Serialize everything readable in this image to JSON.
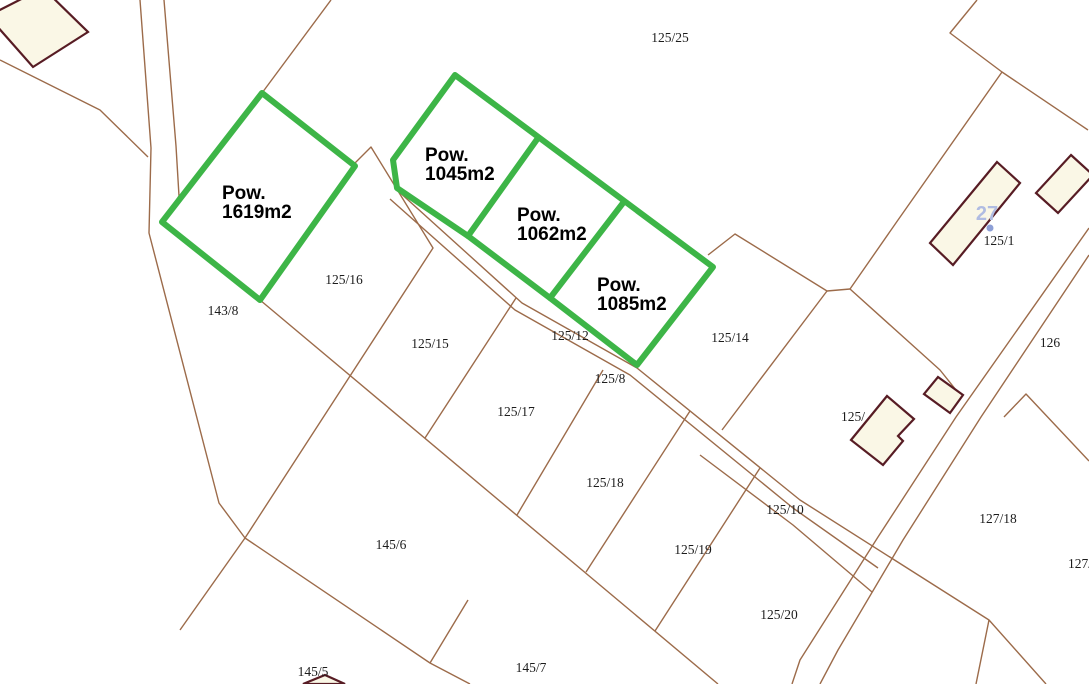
{
  "map": {
    "title": "Cadastral parcel map",
    "canvas": {
      "width": 1089,
      "height": 684,
      "background": "#ffffff"
    },
    "colors": {
      "parcel_line": "#9c6b4a",
      "building_stroke": "#571c24",
      "building_fill": "#faf7e6",
      "highlight_green": "#3db547",
      "label_text": "#1c1c1c",
      "area_label_text": "#000000",
      "address_blue": "#b0bce2",
      "address_dot": "#8d9fd6"
    },
    "parcel_lines": {
      "width": 1.4,
      "paths": [
        [
          [
            140,
            0
          ],
          [
            151,
            148
          ],
          [
            149,
            233
          ],
          [
            219,
            503
          ],
          [
            245,
            538
          ]
        ],
        [
          [
            245,
            538
          ],
          [
            180,
            630
          ]
        ],
        [
          [
            245,
            538
          ],
          [
            430,
            663
          ],
          [
            470,
            684
          ]
        ],
        [
          [
            468,
            600
          ],
          [
            430,
            663
          ]
        ],
        [
          [
            164,
            0
          ],
          [
            176,
            146
          ],
          [
            179,
            196
          ],
          [
            163,
            221
          ]
        ],
        [
          [
            0,
            60
          ],
          [
            100,
            110
          ],
          [
            148,
            157
          ]
        ],
        [
          [
            331,
            0
          ],
          [
            262,
            93
          ]
        ],
        [
          [
            353,
            165
          ],
          [
            371,
            147
          ],
          [
            433,
            248
          ],
          [
            245,
            538
          ]
        ],
        [
          [
            516,
            298
          ],
          [
            425,
            438
          ]
        ],
        [
          [
            603,
            370
          ],
          [
            517,
            515
          ]
        ],
        [
          [
            690,
            411
          ],
          [
            586,
            572
          ]
        ],
        [
          [
            760,
            468
          ],
          [
            655,
            631
          ]
        ],
        [
          [
            260,
            300
          ],
          [
            718,
            684
          ]
        ],
        [
          [
            397,
            190
          ],
          [
            522,
            303
          ],
          [
            637,
            368
          ],
          [
            800,
            500
          ],
          [
            989,
            620
          ],
          [
            1046,
            684
          ]
        ],
        [
          [
            390,
            199
          ],
          [
            515,
            310
          ],
          [
            630,
            375
          ],
          [
            793,
            508
          ],
          [
            878,
            568
          ]
        ],
        [
          [
            700,
            455
          ],
          [
            793,
            525
          ],
          [
            872,
            592
          ]
        ],
        [
          [
            1089,
            255
          ],
          [
            981,
            417
          ],
          [
            903,
            540
          ],
          [
            838,
            650
          ],
          [
            820,
            684
          ]
        ],
        [
          [
            1089,
            228
          ],
          [
            956,
            417
          ],
          [
            878,
            537
          ],
          [
            800,
            660
          ],
          [
            792,
            684
          ]
        ],
        [
          [
            977,
            0
          ],
          [
            950,
            33
          ],
          [
            1002,
            72
          ],
          [
            898,
            220
          ],
          [
            850,
            289
          ]
        ],
        [
          [
            1002,
            72
          ],
          [
            1088,
            130
          ]
        ],
        [
          [
            850,
            289
          ],
          [
            940,
            370
          ],
          [
            960,
            395
          ]
        ],
        [
          [
            708,
            255
          ],
          [
            735,
            234
          ],
          [
            827,
            291
          ],
          [
            850,
            289
          ]
        ],
        [
          [
            827,
            291
          ],
          [
            722,
            430
          ]
        ],
        [
          [
            1004,
            417
          ],
          [
            1026,
            394
          ],
          [
            1089,
            461
          ]
        ],
        [
          [
            989,
            620
          ],
          [
            976,
            684
          ]
        ]
      ]
    },
    "buildings": {
      "stroke_width": 2.2,
      "items": [
        {
          "name": "building-top-left",
          "points": [
            [
              -12,
              16
            ],
            [
              43,
              -12
            ],
            [
              88,
              32
            ],
            [
              33,
              67
            ]
          ]
        },
        {
          "name": "building-125-1",
          "points": [
            [
              997,
              162
            ],
            [
              1020,
              183
            ],
            [
              953,
              265
            ],
            [
              930,
              243
            ]
          ]
        },
        {
          "name": "building-top-right",
          "points": [
            [
              1071,
              155
            ],
            [
              1093,
              175
            ],
            [
              1058,
              213
            ],
            [
              1036,
              193
            ]
          ]
        },
        {
          "name": "building-l-shaped",
          "points": [
            [
              887,
              396
            ],
            [
              914,
              419
            ],
            [
              898,
              436
            ],
            [
              903,
              441
            ],
            [
              883,
              465
            ],
            [
              851,
              440
            ]
          ]
        },
        {
          "name": "building-small-square",
          "points": [
            [
              938,
              377
            ],
            [
              963,
              395
            ],
            [
              950,
              413
            ],
            [
              924,
              394
            ]
          ]
        },
        {
          "name": "building-bottom-edge",
          "points": [
            [
              325,
              675
            ],
            [
              345,
              684
            ],
            [
              303,
              684
            ]
          ]
        }
      ]
    },
    "parcel_labels": {
      "font_size": 13.5,
      "items": [
        {
          "text": "125/25",
          "x": 670,
          "y": 42
        },
        {
          "text": "143/8",
          "x": 223,
          "y": 315
        },
        {
          "text": "125/16",
          "x": 344,
          "y": 284
        },
        {
          "text": "125/15",
          "x": 430,
          "y": 348
        },
        {
          "text": "125/12",
          "x": 570,
          "y": 340
        },
        {
          "text": "125/8",
          "x": 610,
          "y": 383
        },
        {
          "text": "125/14",
          "x": 730,
          "y": 342
        },
        {
          "text": "125/17",
          "x": 516,
          "y": 416
        },
        {
          "text": "125/18",
          "x": 605,
          "y": 487
        },
        {
          "text": "125/19",
          "x": 693,
          "y": 554
        },
        {
          "text": "125/10",
          "x": 785,
          "y": 514
        },
        {
          "text": "125/20",
          "x": 779,
          "y": 619
        },
        {
          "text": "145/6",
          "x": 391,
          "y": 549
        },
        {
          "text": "145/5",
          "x": 313,
          "y": 676
        },
        {
          "text": "145/7",
          "x": 531,
          "y": 672
        },
        {
          "text": "125/1",
          "x": 999,
          "y": 245
        },
        {
          "text": "126",
          "x": 1050,
          "y": 347
        },
        {
          "text": "127/18",
          "x": 998,
          "y": 523
        },
        {
          "text": "127/",
          "x": 1080,
          "y": 568
        },
        {
          "text": "125/",
          "x": 853,
          "y": 421,
          "behind_buildings": true
        }
      ]
    },
    "highlight": {
      "stroke_width": 6,
      "shapes": [
        {
          "name": "highlight-parcel-1619",
          "closed": true,
          "points": [
            [
              262,
              93
            ],
            [
              355,
              166
            ],
            [
              260,
              300
            ],
            [
              162,
              222
            ]
          ]
        },
        {
          "name": "highlight-parcel-band",
          "closed": true,
          "points": [
            [
              455,
              75
            ],
            [
              713,
              267
            ],
            [
              637,
              365
            ],
            [
              550,
              298
            ],
            [
              468,
              236
            ],
            [
              397,
              188
            ],
            [
              393,
              160
            ]
          ]
        },
        {
          "name": "highlight-divider-1",
          "closed": false,
          "points": [
            [
              538,
              138
            ],
            [
              468,
              236
            ]
          ]
        },
        {
          "name": "highlight-divider-2",
          "closed": false,
          "points": [
            [
              623,
              203
            ],
            [
              550,
              298
            ]
          ]
        }
      ],
      "area_labels": {
        "font_size": 19,
        "line_height": 19,
        "items": [
          {
            "lines": [
              "Pow.",
              "1619m2"
            ],
            "x": 222,
            "y": 199
          },
          {
            "lines": [
              "Pow.",
              "1045m2"
            ],
            "x": 425,
            "y": 161
          },
          {
            "lines": [
              "Pow.",
              "1062m2"
            ],
            "x": 517,
            "y": 221
          },
          {
            "lines": [
              "Pow.",
              "1085m2"
            ],
            "x": 597,
            "y": 291
          }
        ]
      }
    },
    "address_marker": {
      "text": "27",
      "x": 987,
      "y": 220,
      "font_size": 20,
      "dot": {
        "x": 990,
        "y": 228,
        "r": 3.5
      }
    }
  }
}
